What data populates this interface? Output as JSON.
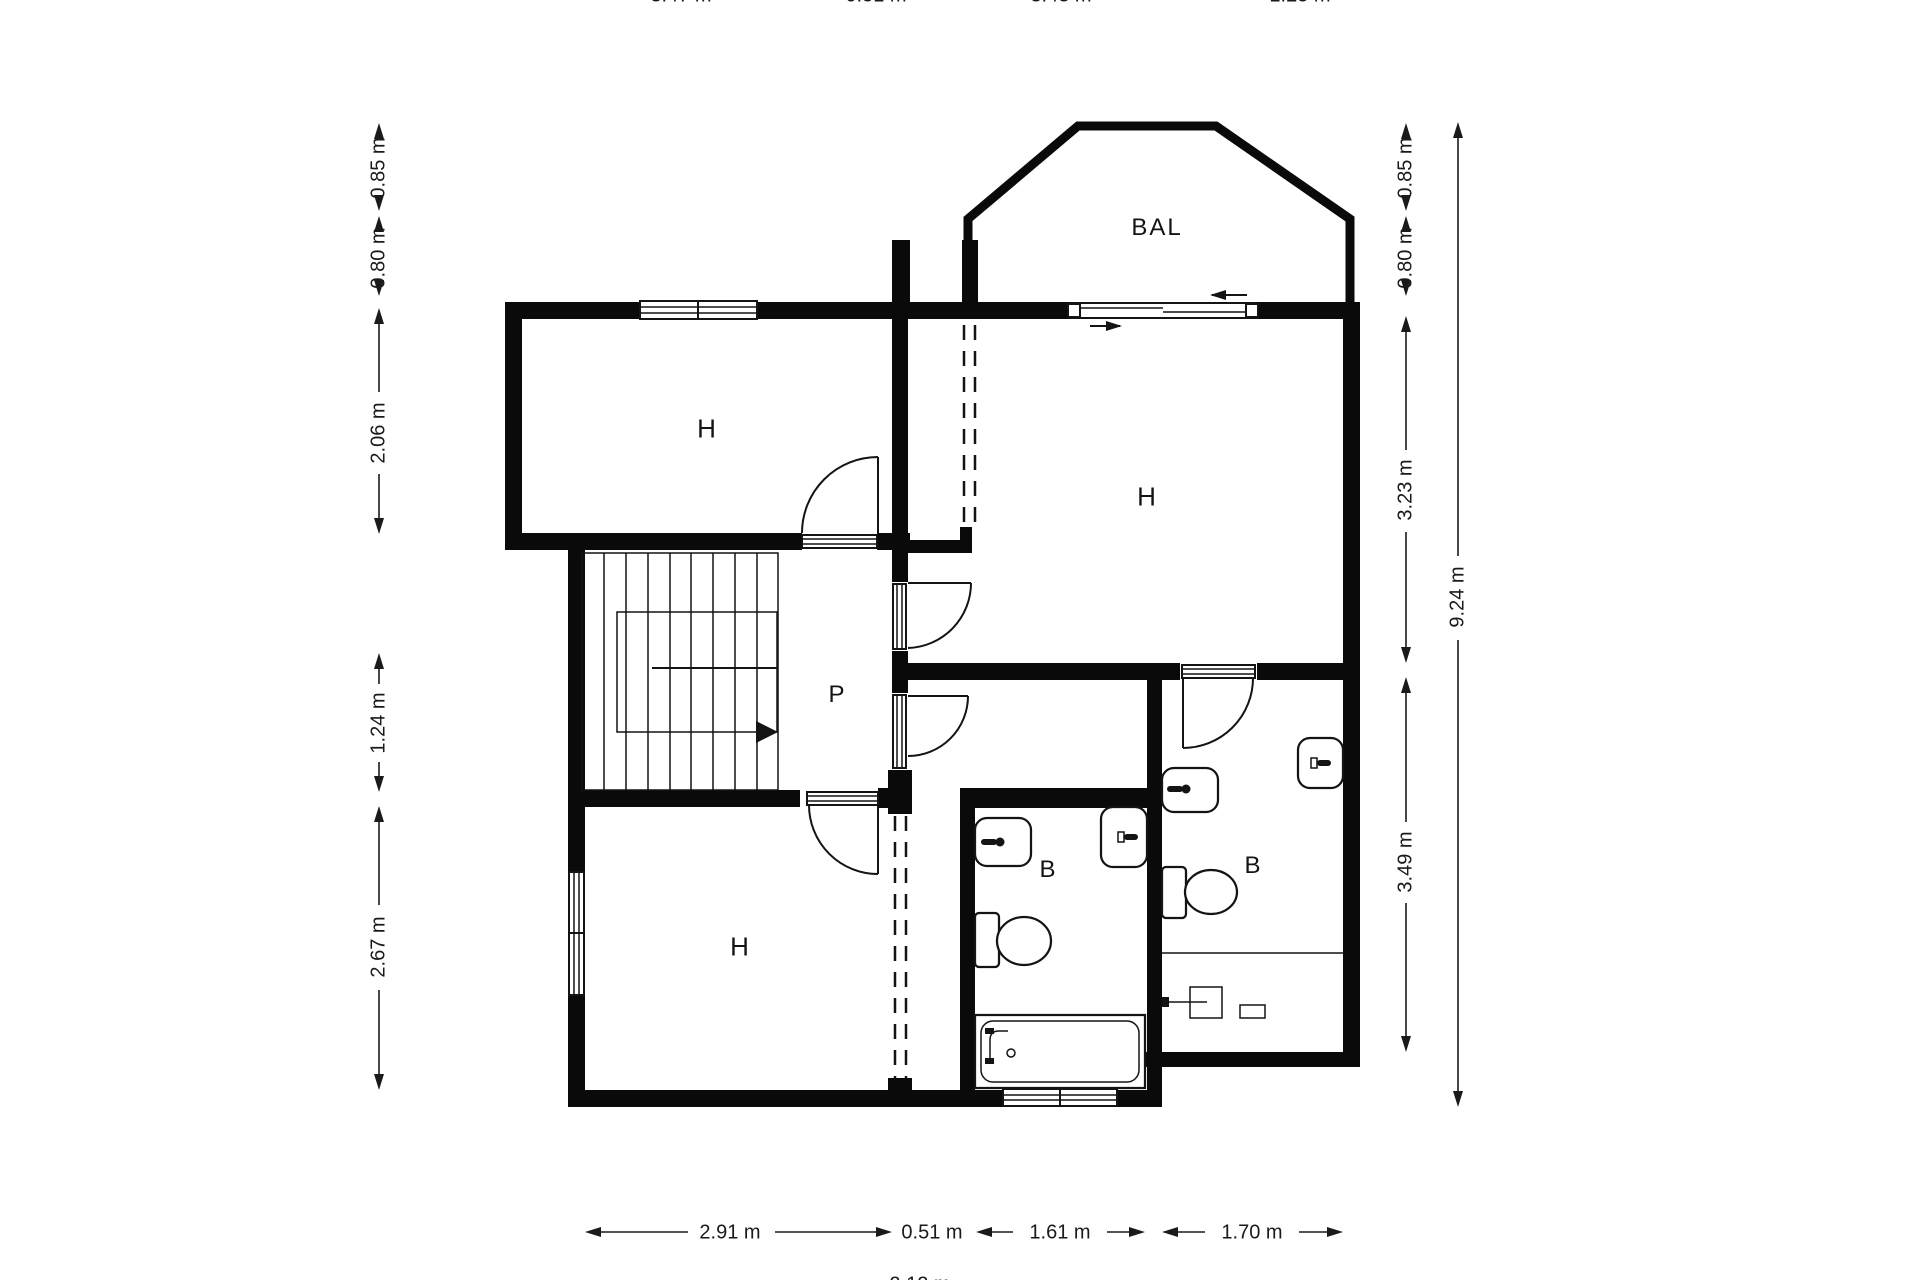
{
  "rooms": {
    "top_left": "H",
    "top_right": "H",
    "bottom": "H",
    "hall": "P",
    "bath_middle": "B",
    "bath_right": "B",
    "balcony": "BAL"
  },
  "dimensions": {
    "left": [
      "0.85 m",
      "0.80 m",
      "2.06 m",
      "1.24 m",
      "2.67 m"
    ],
    "right": [
      "0.85 m",
      "0.80 m",
      "3.23 m",
      "3.49 m"
    ],
    "right_total": "9.24 m",
    "bottom": [
      "2.91 m",
      "0.51 m",
      "1.61 m",
      "1.70 m"
    ],
    "bottom_sum_clipped": "2.12 m",
    "top_clipped": [
      "3.47 m",
      "0.51 m",
      "3.43 m",
      "1.25 m"
    ]
  },
  "colors": {
    "wall": "#0a0a0a",
    "line": "#141414",
    "dim": "#1a1a1a",
    "bg": "#ffffff"
  }
}
